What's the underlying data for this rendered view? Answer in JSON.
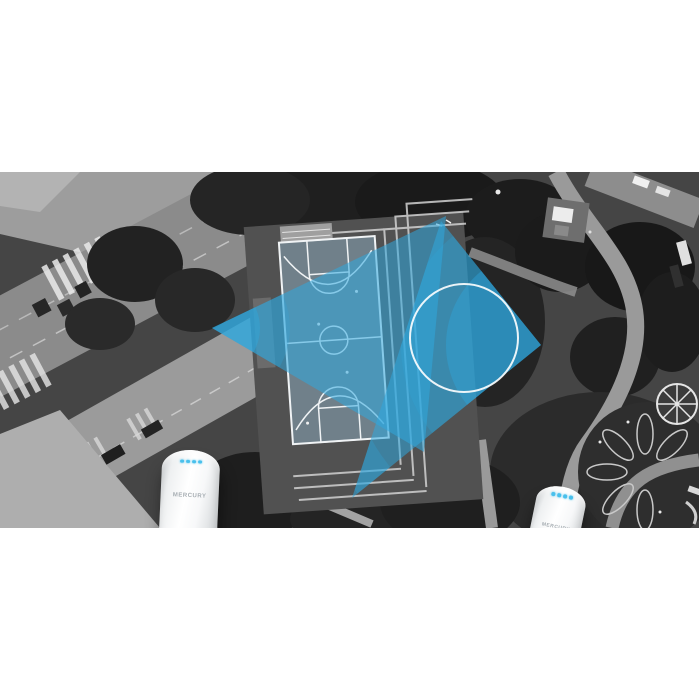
{
  "meta": {
    "alt": "Grayscale aerial photo of a park with a basketball court; two white MERCURY outdoor wireless access points face each other and exchange overlapping blue signal beams across the court"
  },
  "palette": {
    "background": "#ffffff",
    "signal_blue": "#2fa8de",
    "led_blue": "#49c0ec",
    "device_body": "#ffffff",
    "photo_style": "grayscale"
  },
  "devices": {
    "left": {
      "brand": "MERCURY",
      "led_count": 4
    },
    "right": {
      "brand": "MERCURY",
      "led_count": 4
    }
  }
}
